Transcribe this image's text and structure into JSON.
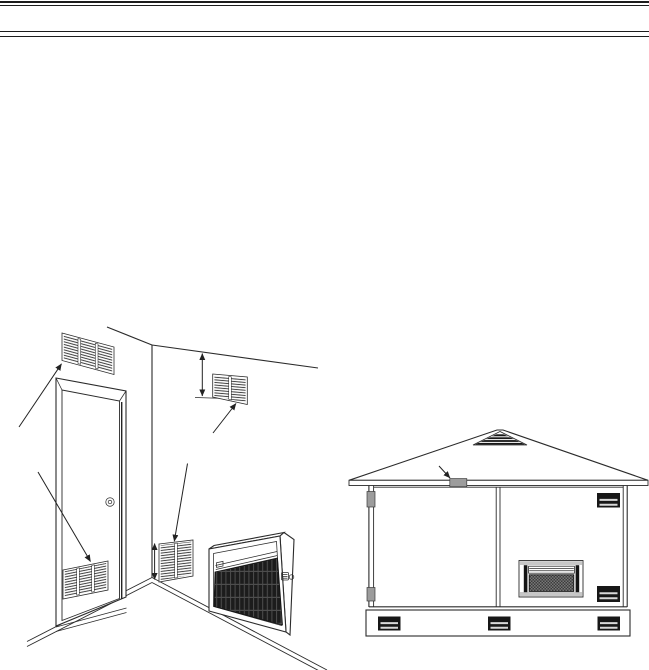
{
  "page": {
    "background": "#ffffff",
    "rule_color": "#1d1d1d"
  },
  "colors": {
    "line": "#2b2b2b",
    "vent_gray": "#9c9c9c",
    "vent_dark": "#171717",
    "vent_stripe": "#d9d9d9",
    "heater_band_gray": "#c7c7c7",
    "grille_dark": "#1c1c1c",
    "mesh_light": "#777777"
  }
}
